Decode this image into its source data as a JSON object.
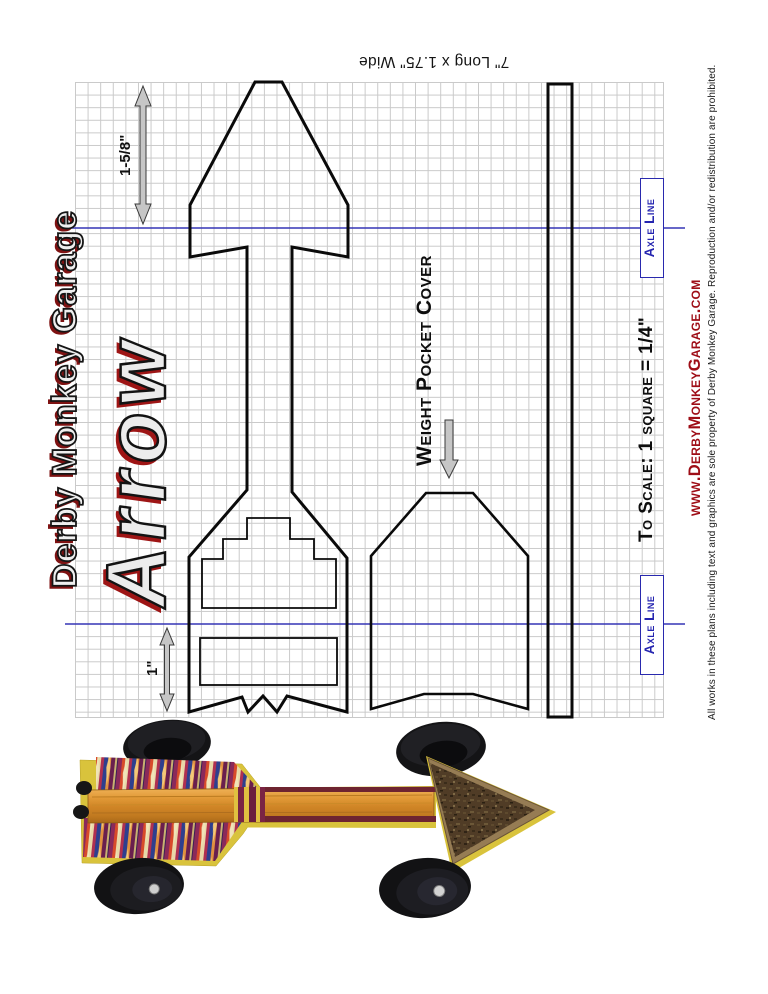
{
  "document": {
    "size_note": "7\" Long x 1.75\" Wide",
    "brand_title": "Derby Monkey Garage",
    "model_title": "Arrow",
    "weight_pocket_cover_label": "Weight Pocket Cover",
    "axle_line_label": "Axle Line",
    "scale_note": "To Scale: 1 square = 1/4\"",
    "dimension_head_width": "1-5/8\"",
    "dimension_tail_width": "1\"",
    "website": "www.DerbyMonkeyGarage.com",
    "copyright": "All works in these plans including text and graphics are sole property of Derby Monkey Garage.  Reproduction and/or redistribution are prohibited."
  },
  "colors": {
    "axle_line_blue": "#3535b5",
    "axle_label_blue": "#2525b0",
    "title_shadow_red": "#8c1414",
    "website_red": "#9e0d16",
    "grid_gray": "#c9c9c9",
    "template_outline": "#0a0a0a",
    "car_body_yellow": "#d9c33c",
    "dimension_arrow_gray": "#c6c6c6"
  }
}
